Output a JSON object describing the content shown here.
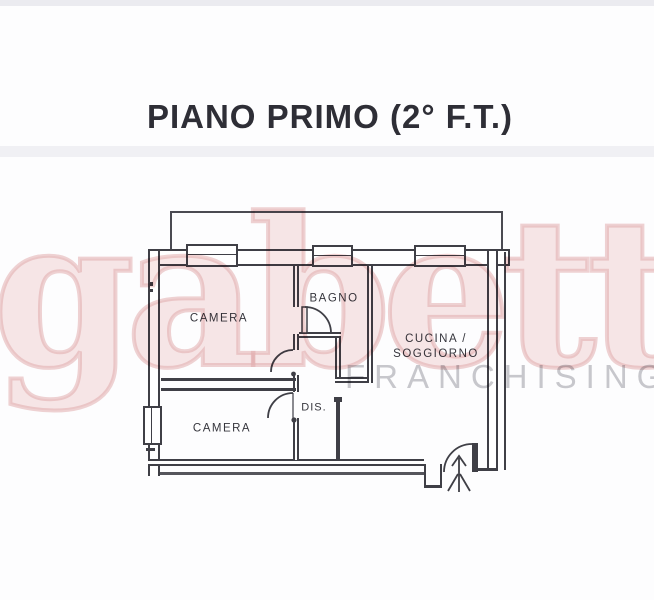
{
  "title": "PIANO PRIMO (2° F.T.)",
  "watermark": {
    "brand": "gabetti",
    "subbrand": "FRANCHISING",
    "brand_color": "#e8b4b4",
    "subbrand_color": "#c9c9cd"
  },
  "floorplan": {
    "line_color": "#3f3f46",
    "rooms": [
      {
        "id": "camera-top",
        "label": "CAMERA"
      },
      {
        "id": "bagno",
        "label": "BAGNO"
      },
      {
        "id": "cucina-soggiorno",
        "label_line1": "CUCINA /",
        "label_line2": "SOGGIORNO"
      },
      {
        "id": "camera-bottom",
        "label": "CAMERA"
      },
      {
        "id": "dis",
        "label": "DIS."
      }
    ]
  }
}
